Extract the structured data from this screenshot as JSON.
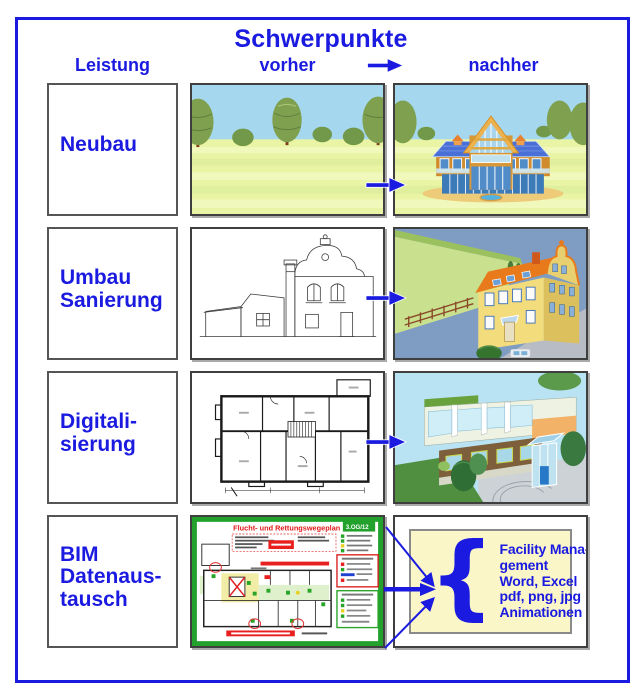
{
  "title": "Schwerpunkte",
  "columns": {
    "service": "Leistung",
    "before": "vorher",
    "after": "nachher"
  },
  "rows": [
    {
      "label": "Neubau"
    },
    {
      "label": "Umbau\nSanierung"
    },
    {
      "label": "Digitali-\nsierung"
    },
    {
      "label": "BIM\nDatenaus-\ntausch"
    }
  ],
  "escape_plan": {
    "title": "Flucht- und Rettungswegeplan",
    "floor": "3.OG/12"
  },
  "bim_outputs": [
    "Facility Mana-",
    "gement",
    "Word, Excel",
    "pdf, png, jpg",
    "Animationen"
  ],
  "icons": {
    "header_arrow": "right-arrow",
    "row_arrow": "right-arrow",
    "brace": "left-curly-brace"
  },
  "colors": {
    "accent_blue": "#1a1ae0",
    "plan_green": "#22a12c",
    "plan_red": "#e02020",
    "panel_cream": "#faf6c8"
  }
}
